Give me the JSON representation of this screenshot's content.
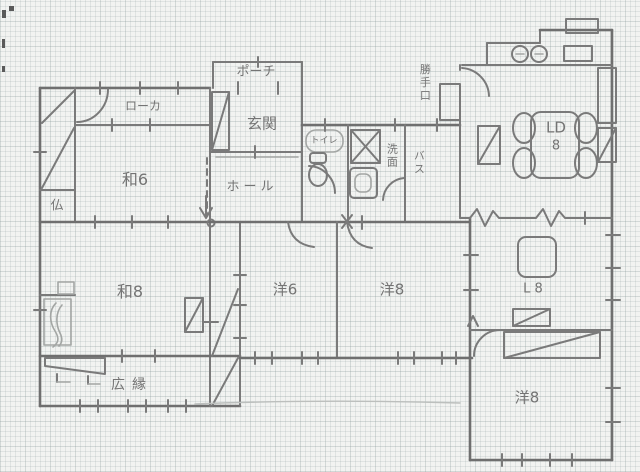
{
  "title": "hand-drawn house floor plan sketch",
  "colors": {
    "paper": "#f2f3f1",
    "grid": "#cbd4d3",
    "pencil": "#7a7a7a"
  },
  "labels": {
    "porch": "ポーチ",
    "genkan": "玄関",
    "roka": "ローカ",
    "wa6": "和6",
    "butsu": "仏",
    "hall": "ホール",
    "toilet": "トイレ",
    "senmen": "洗面",
    "bath": "バス",
    "katteguchi": "勝手口",
    "ld_line1": "LD",
    "ld_line2": "8",
    "l8": "L 8",
    "wa8": "和8",
    "yo6": "洋6",
    "yo8_center": "洋8",
    "hiroen": "広縁",
    "yo8_south": "洋8"
  },
  "icons": {
    "toilet": "toilet-bowl-icon",
    "washing_machine": "crossed-box-icon",
    "washbasin": "basin-icon",
    "kitchen_sink": "double-sink-icon",
    "stove": "stove-icon",
    "dining_table": "dining-table-with-chairs-icon",
    "living_table": "square-table-icon",
    "stairs": "stairs-icon",
    "tokonoma": "alcove-ornament-squiggle-icon"
  }
}
